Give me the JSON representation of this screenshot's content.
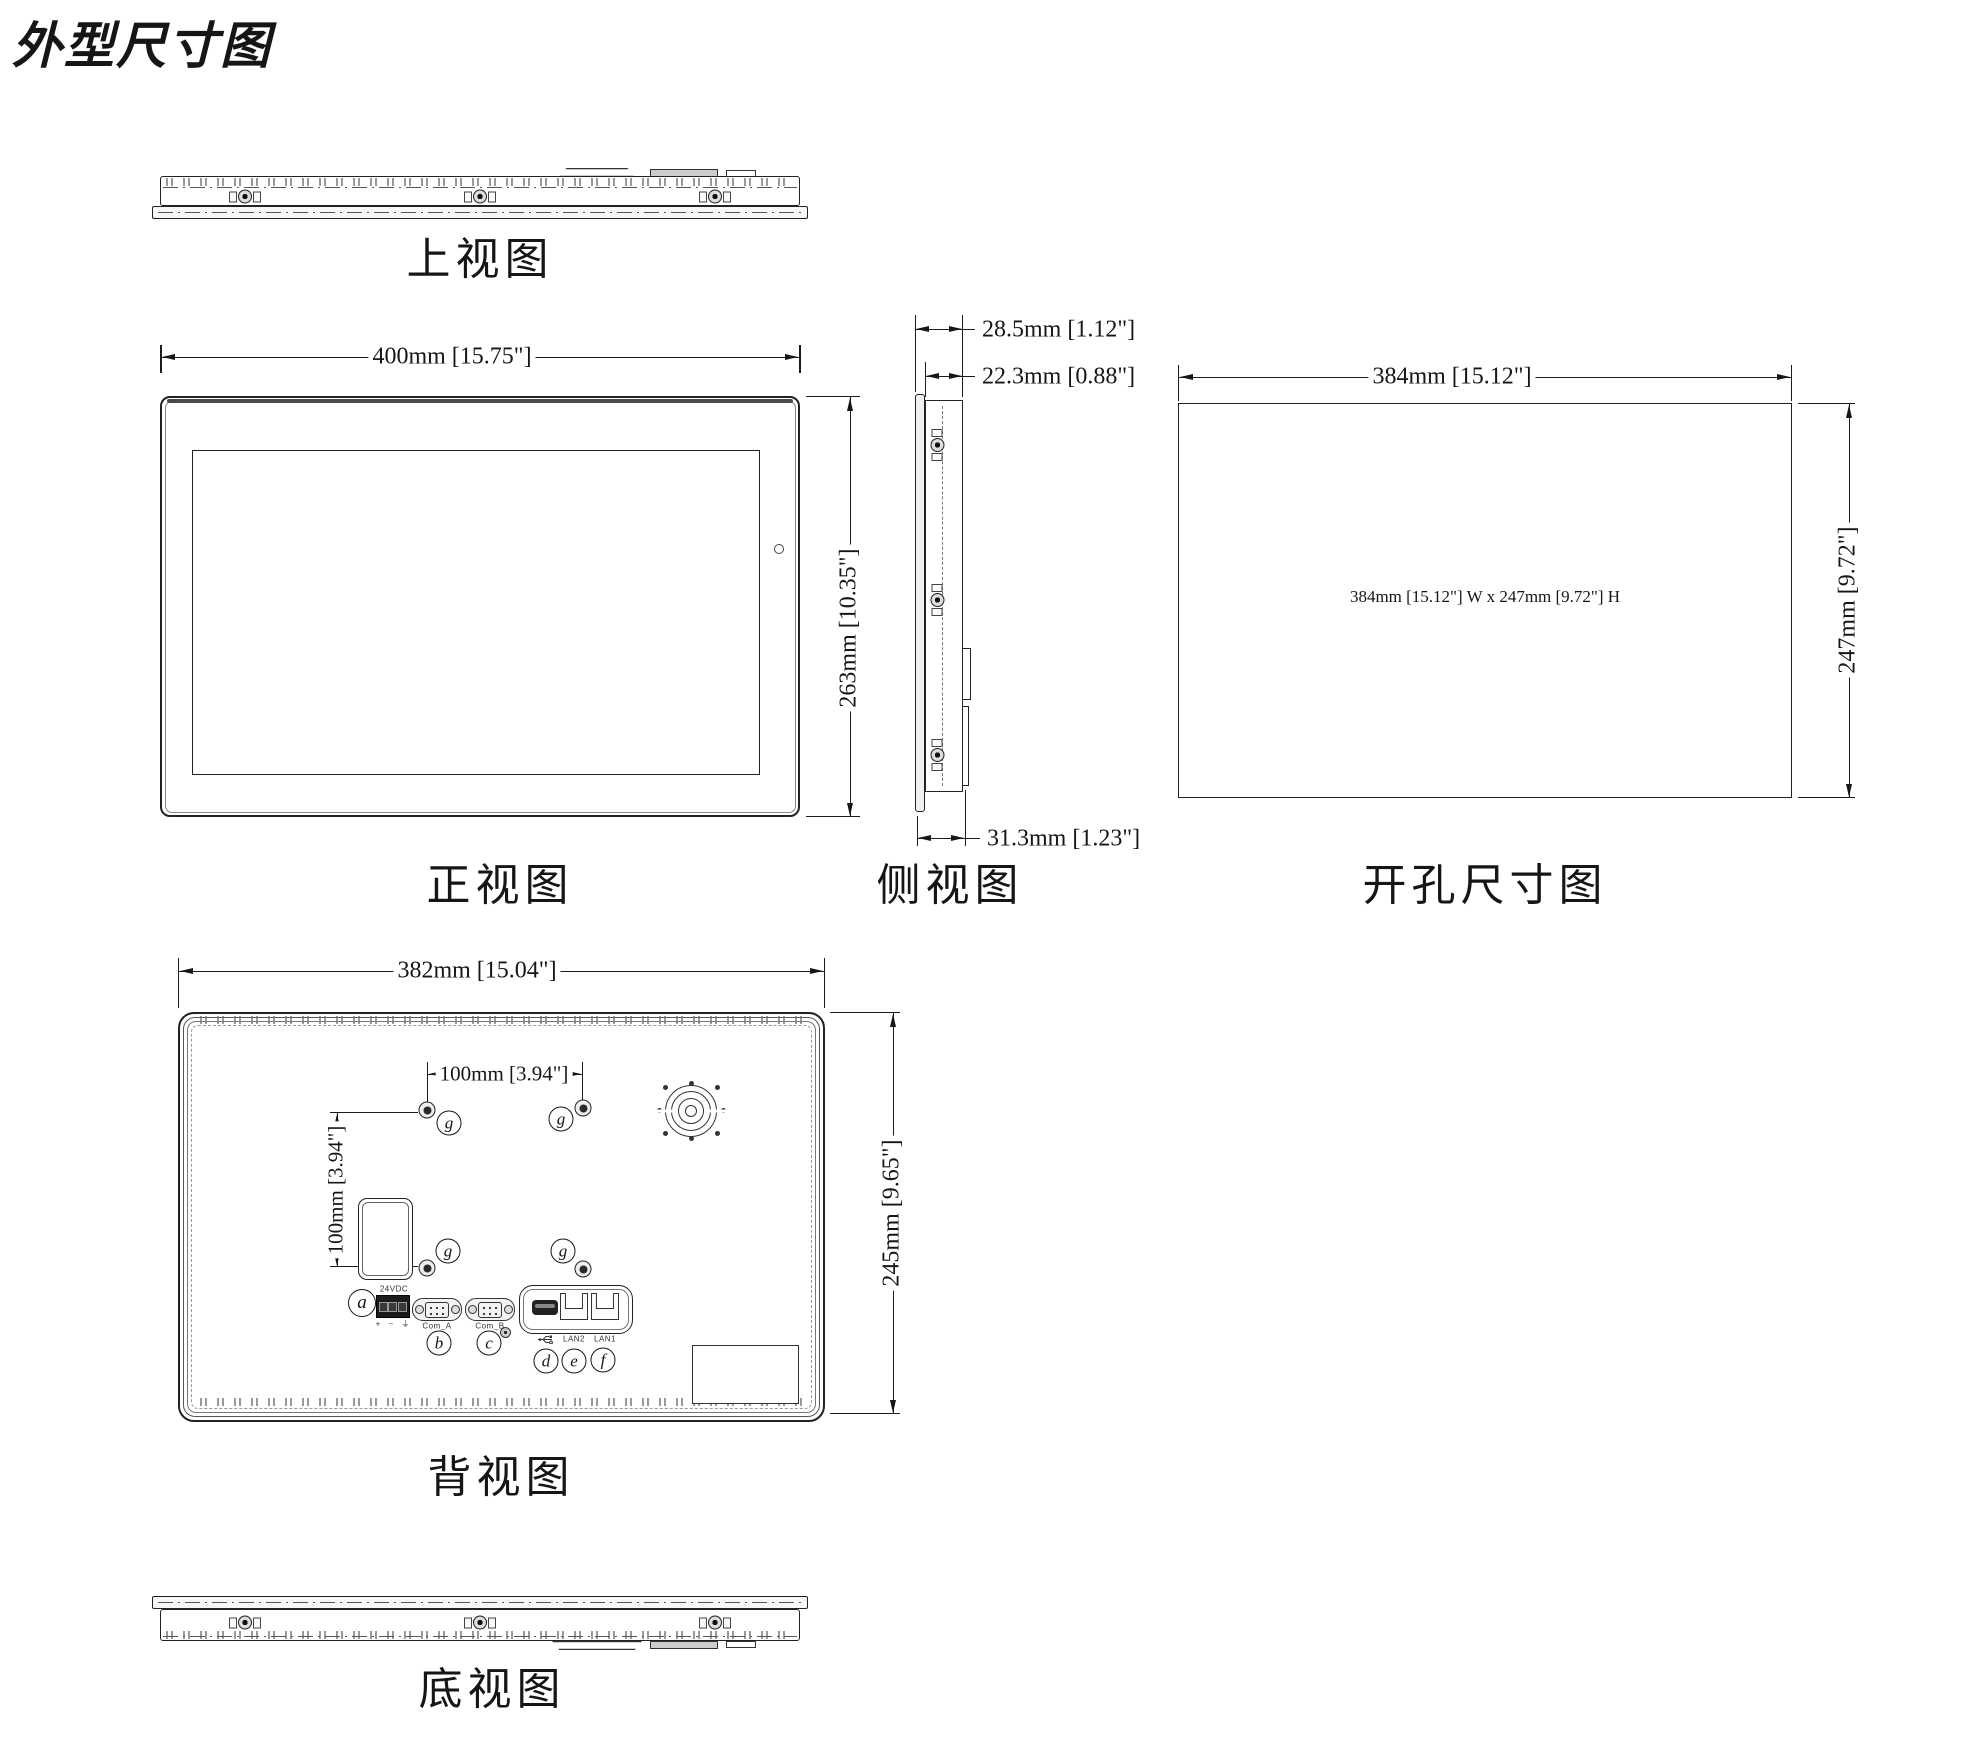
{
  "title": "外型尺寸图",
  "views": {
    "top": {
      "label": "上视图"
    },
    "front": {
      "label": "正视图",
      "dim_width": "400mm [15.75\"]",
      "dim_height": "263mm [10.35\"]"
    },
    "side": {
      "label": "侧视图",
      "dim_depth_total": "28.5mm [1.12\"]",
      "dim_depth_body": "22.3mm [0.88\"]",
      "dim_depth_connector": "31.3mm [1.23\"]"
    },
    "cutout": {
      "label": "开孔尺寸图",
      "dim_width": "384mm [15.12\"]",
      "dim_height": "247mm [9.72\"]",
      "center_note": "384mm [15.12\"] W x 247mm [9.72\"] H"
    },
    "rear": {
      "label": "背视图",
      "dim_width": "382mm [15.04\"]",
      "dim_height": "245mm [9.65\"]",
      "dim_vesa_h": "100mm [3.94\"]",
      "dim_vesa_v": "100mm [3.94\"]"
    },
    "bottom": {
      "label": "底视图"
    }
  },
  "callouts": {
    "a": "a",
    "b": "b",
    "c": "c",
    "d": "d",
    "e": "e",
    "f": "f",
    "g": "g"
  },
  "ports": {
    "power_label": "24VDC",
    "power_pins": "+ − ⏚",
    "com_a": "Com_A",
    "com_b": "Com_B",
    "lan2": "LAN2",
    "lan1": "LAN1"
  },
  "colors": {
    "line": "#1c1c1c",
    "paper": "#ffffff"
  }
}
